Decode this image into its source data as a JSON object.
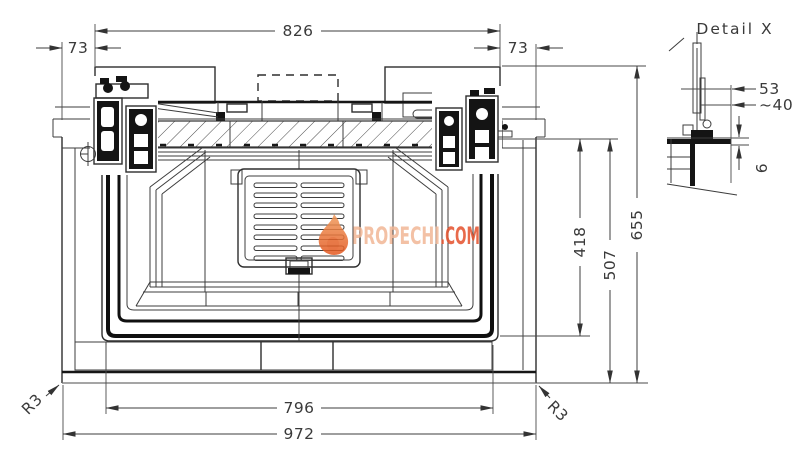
{
  "page": {
    "background": "#ffffff"
  },
  "dimensions": {
    "top_width": "826",
    "top_offset_left": "73",
    "top_offset_right": "73",
    "opening_height": "418",
    "body_height": "507",
    "total_height": "655",
    "base_inner_width": "796",
    "total_width": "972",
    "corner_radius_left": "R3",
    "corner_radius_right": "R3"
  },
  "detail_view": {
    "title": "Detail X",
    "offset_53": "53",
    "offset_40": "~40",
    "thickness_6": "6"
  },
  "watermark": {
    "brand": "PROPECHI",
    "suffix": ".COM",
    "brand_color": "#f2b796",
    "suffix_color": "#e4512c",
    "flame_top": "#f09a5a",
    "flame_bottom": "#e4571f"
  },
  "colors": {
    "line": "#3d3d3d",
    "heavy": "#111111"
  }
}
